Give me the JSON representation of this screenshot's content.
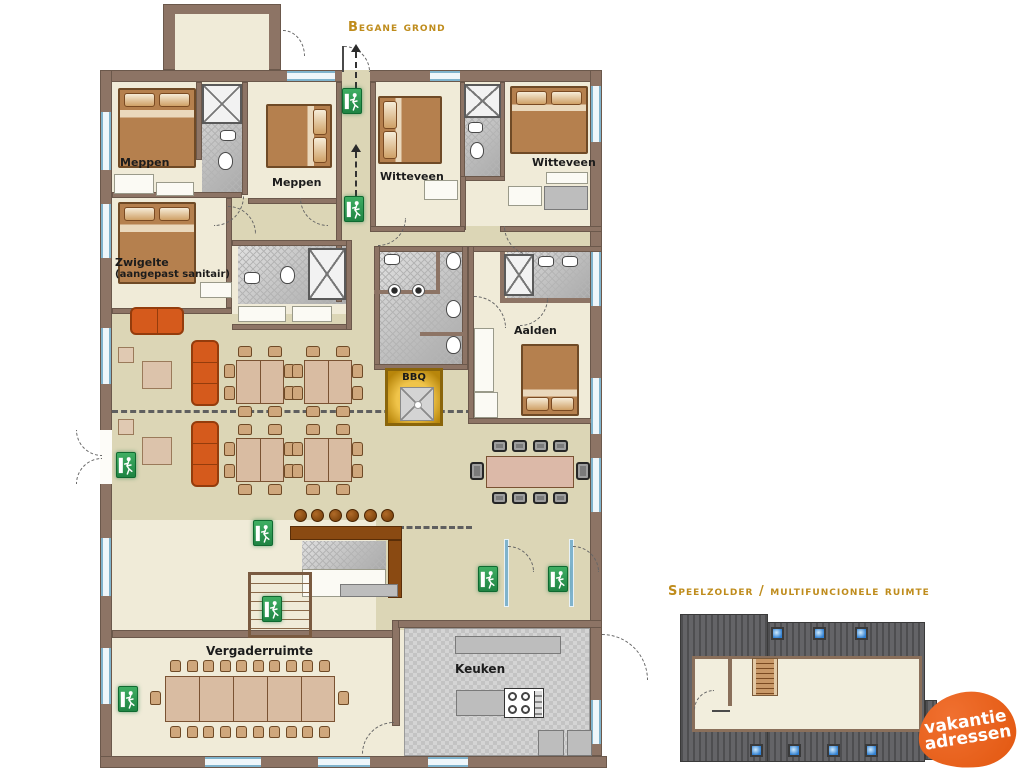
{
  "titles": {
    "main": "Begane grond",
    "secondary": "Speelzolder / multifuncionele ruimte"
  },
  "rooms": {
    "meppen_left": "Meppen",
    "meppen_mid": "Meppen",
    "witteveen_left": "Witteveen",
    "witteveen_right": "Witteveen",
    "zwigelte": "Zwigelte",
    "zwigelte_sub": "(aangepast sanitair)",
    "aalden": "Aalden",
    "bbq": "BBQ",
    "vergaderruimte": "Vergaderruimte",
    "keuken": "Keuken"
  },
  "logo": {
    "line1": "vakantie",
    "line2": "adressen"
  },
  "colors": {
    "title_gold": "#bf8c1c",
    "exit_green": "#2f9e52",
    "logo_orange": "#e2570f",
    "wall_brown": "#8d7465",
    "sofa_orange": "#d55a1c",
    "skylight_blue": "#2f7fd1",
    "floor_cream": "#f0ebd8",
    "floor_khaki": "#dcd6b6"
  },
  "icons": {
    "emergency_exit": "running-man-exit-sign",
    "door": "door-swing-arc",
    "window": "window-marker",
    "skylight": "skylight-square",
    "stairs": "staircase",
    "bbq": "bbq-grill",
    "shower": "shower-cross",
    "toilet": "toilet-bowl",
    "sink": "wash-basin",
    "stove": "four-burner-stove"
  }
}
